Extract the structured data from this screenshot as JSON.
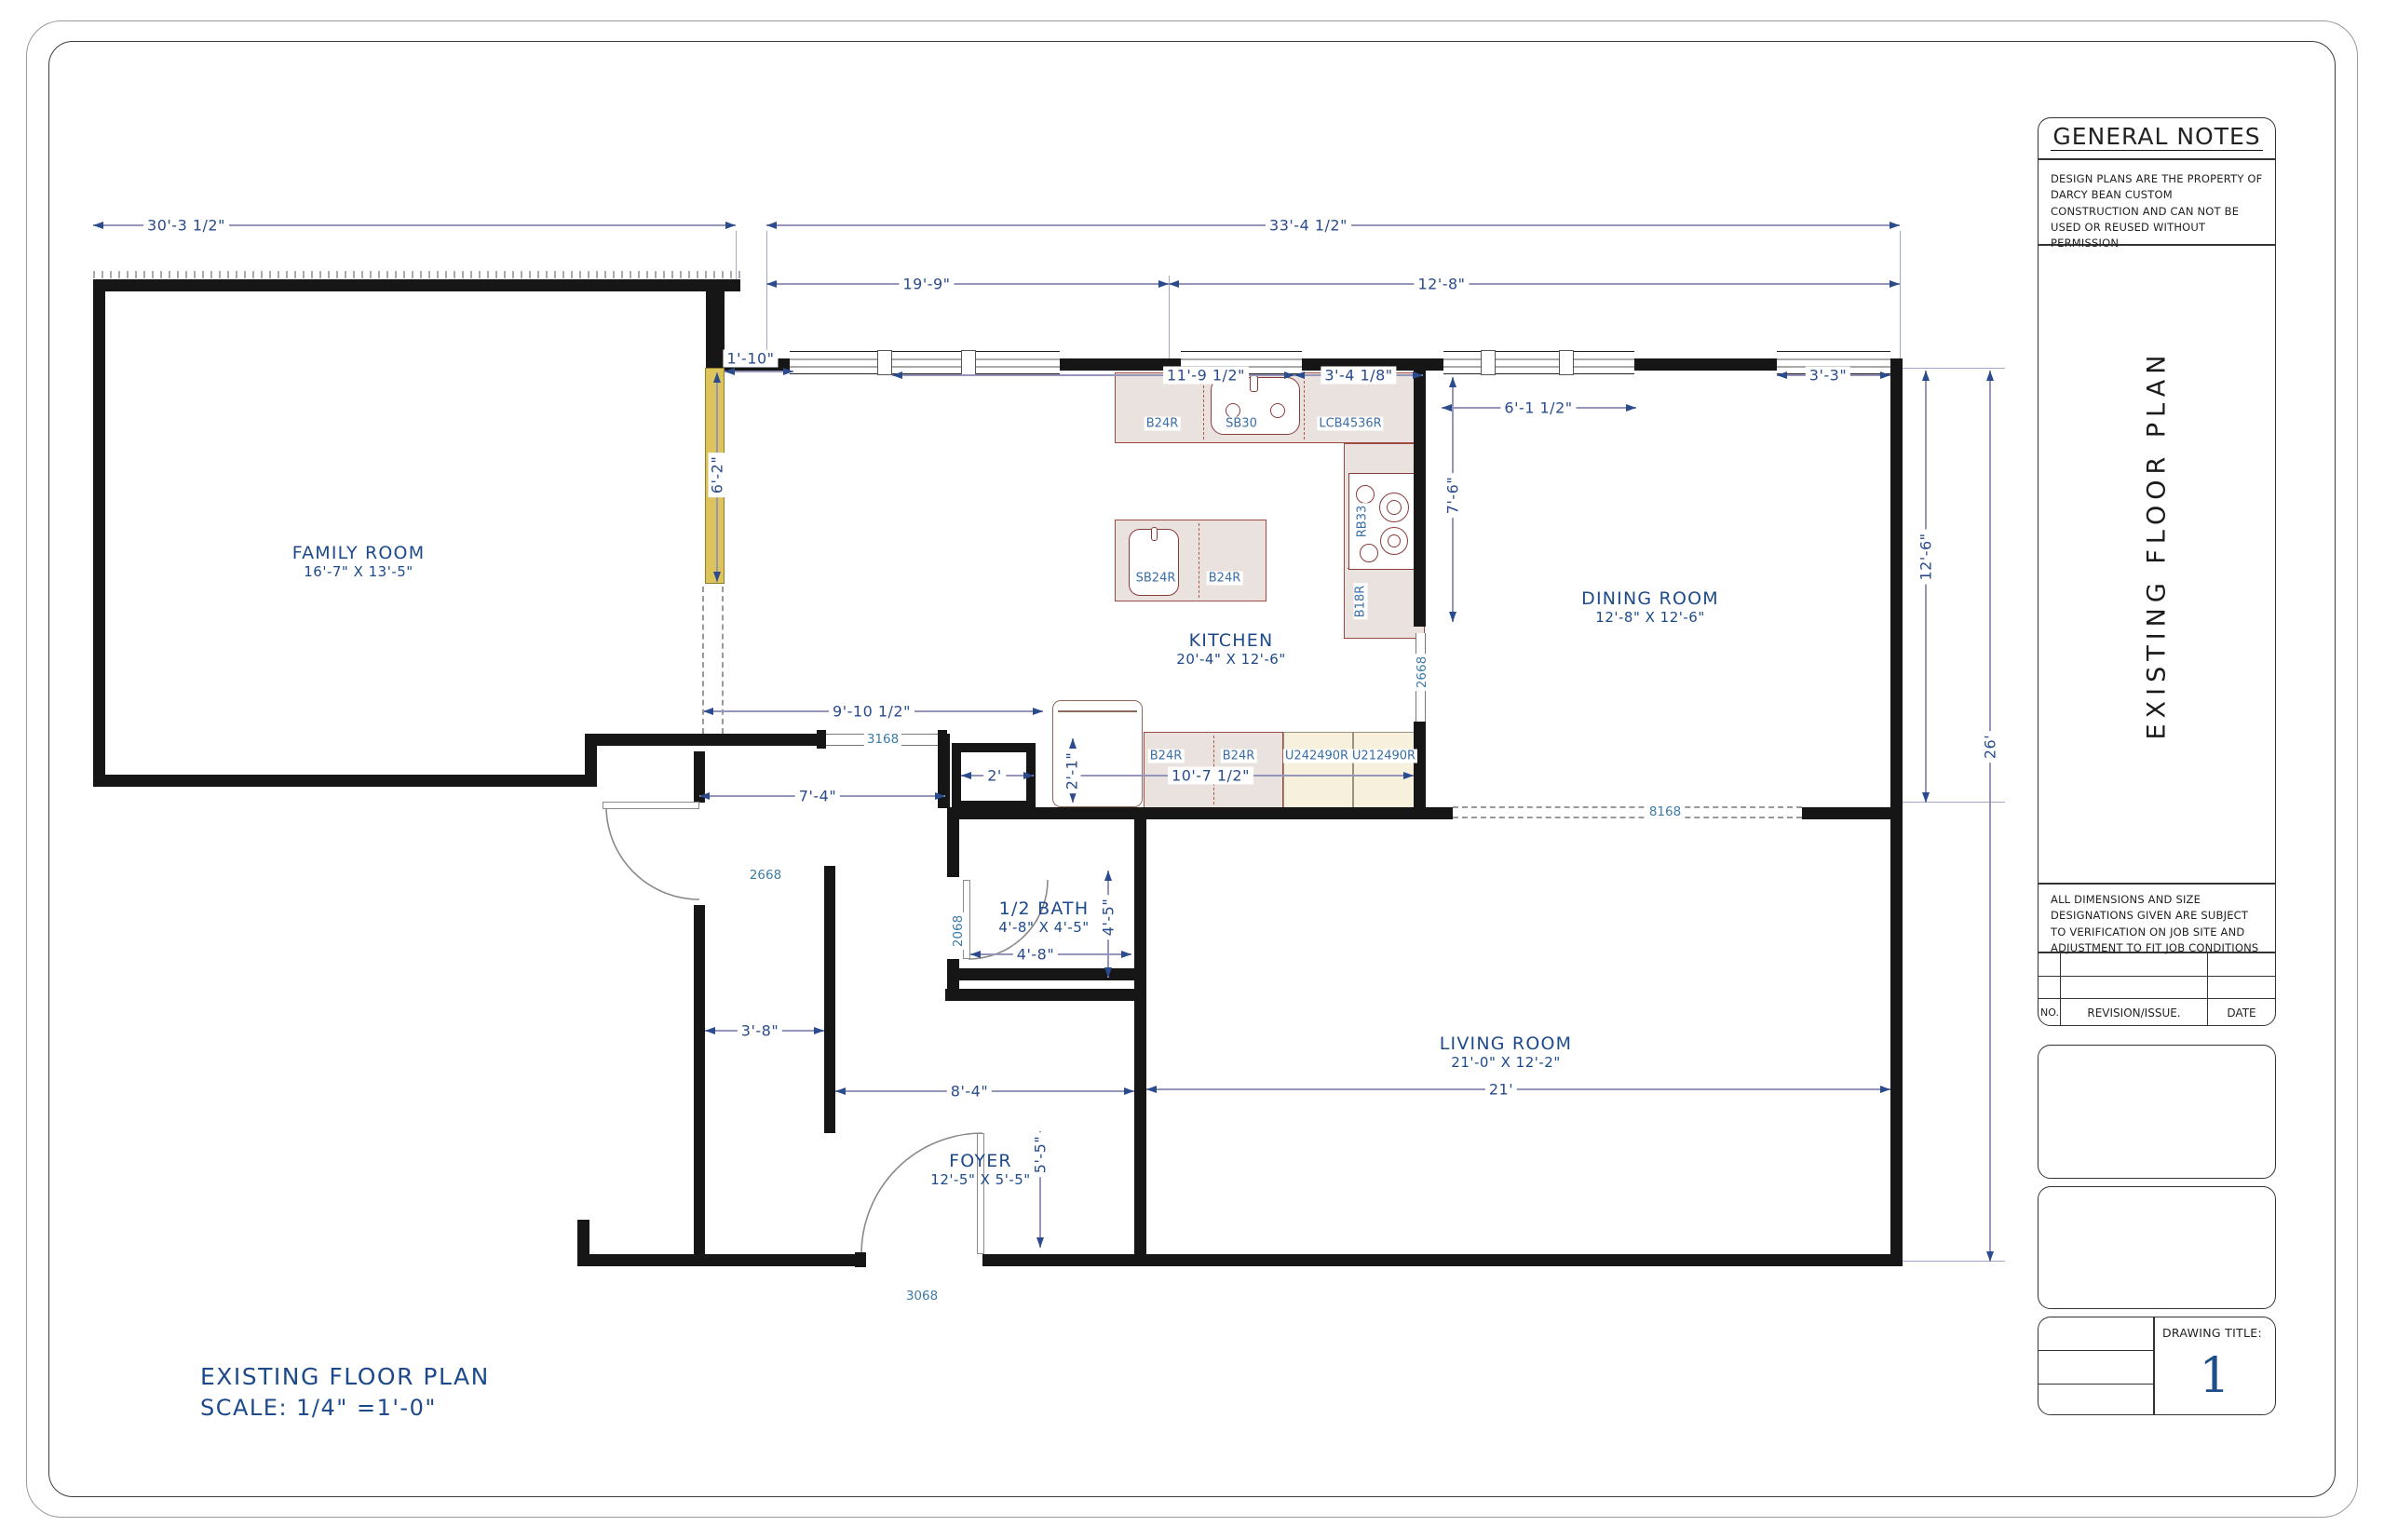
{
  "title_block": {
    "notes_title": "GENERAL NOTES",
    "notes_body": "DESIGN PLANS ARE THE PROPERTY OF DARCY BEAN CUSTOM CONSTRUCTION AND CAN NOT BE USED OR REUSED WITHOUT PERMISSION",
    "side_title": "EXISTING FLOOR PLAN",
    "dim_note": "ALL DIMENSIONS AND SIZE DESIGNATIONS GIVEN ARE SUBJECT TO VERIFICATION ON JOB SITE AND ADJUSTMENT TO FIT JOB CONDITIONS",
    "rev_no": "NO.",
    "rev_label": "REVISION/ISSUE.",
    "rev_date": "DATE",
    "drawing_title_label": "DRAWING TITLE:",
    "drawing_number": "1"
  },
  "footer": {
    "line1": "EXISTING FLOOR PLAN",
    "line2": "SCALE: 1/4\" =1'-0\""
  },
  "rooms": {
    "family": {
      "name": "FAMILY ROOM",
      "size": "16'-7\" X 13'-5\""
    },
    "kitchen": {
      "name": "KITCHEN",
      "size": "20'-4\" X 12'-6\""
    },
    "dining": {
      "name": "DINING ROOM",
      "size": "12'-8\" X 12'-6\""
    },
    "living": {
      "name": "LIVING ROOM",
      "size": "21'-0\" X 12'-2\""
    },
    "foyer": {
      "name": "FOYER",
      "size": "12'-5\" X 5'-5\""
    },
    "bath": {
      "name": "1/2 BATH",
      "size": "4'-8\" X 4'-5\""
    }
  },
  "dims": {
    "overall_left": "30'-3 1/2\"",
    "overall_right": "33'-4 1/2\"",
    "top_left": "19'-9\"",
    "top_right": "12'-8\"",
    "jog": "1'-10\"",
    "kitchen_wall": "11'-9 1/2\"",
    "kitchen_wall2": "3'-4 1/8\"",
    "dining_window": "6'-1 1/2\"",
    "corner": "3'-3\"",
    "fr_wall": "6'-2\"",
    "kitchen_depth": "7'-6\"",
    "dining_depth": "12'-6\"",
    "right_height": "26'",
    "hall_top": "9'-10 1/2\"",
    "closet2": "2'",
    "appliance": "2'-1\"",
    "hall_width": "7'-4\"",
    "cab_run": "10'-7 1/2\"",
    "closet": "3'-8\"",
    "foyer_width": "8'-4\"",
    "living_width": "21'",
    "foyer_depth": "5'-5\"",
    "bath_width": "4'-8\"",
    "bath_depth": "4'-5\""
  },
  "openings": {
    "kitchen_pass": "3168",
    "hall_door": "2668",
    "bath_door": "2068",
    "dining_pass": "2668",
    "living_pass": "8168",
    "front_door": "3068"
  },
  "cabinets": {
    "b24r_top": "B24R",
    "sb30": "SB30",
    "lcb4536r": "LCB4536R",
    "sb24r": "SB24R",
    "b24r_island": "B24R",
    "rb33": "RB33",
    "b18r": "B18R",
    "b24r_low1": "B24R",
    "b24r_low2": "B24R",
    "u242490r": "U242490R",
    "u212490r": "U212490R"
  },
  "colors": {
    "dim_blue": "#2a4b8d",
    "label_blue": "#1d4a8a",
    "cabinet_blue": "#3a6ea5",
    "wall_black": "#161616",
    "highlight_yellow": "#dcc35a",
    "cabinet_red": "#9c4a42"
  }
}
